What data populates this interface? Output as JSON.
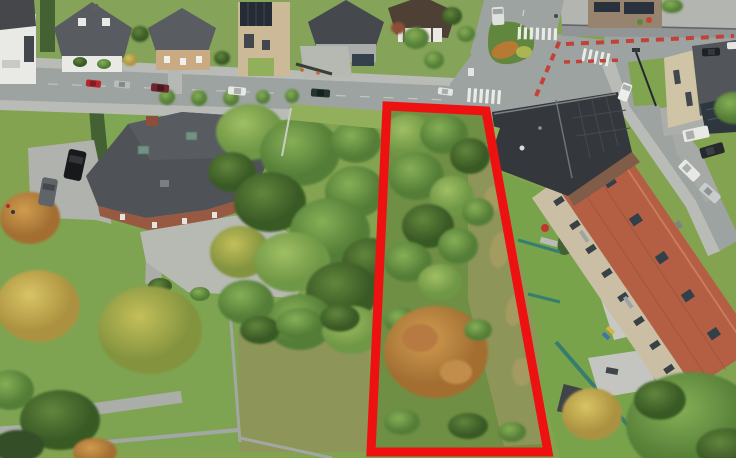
{
  "scene": {
    "type": "aerial-drone-photo",
    "subject": "vacant building plot outlined in red within a residential neighborhood"
  },
  "palette": {
    "base": "#7fa04c",
    "road": "#9aa09e",
    "sidewalk": "#b7bab4",
    "lawn": "#7ba44d",
    "lawn_light": "#8fae56",
    "meadow": "#8b9254",
    "villa_roof": "#4a4e53",
    "brick": "#94543c",
    "rowhouse_roof": "#b25a3e",
    "rowhouse_wall": "#c9bda3",
    "dark_building": "#2e3236",
    "fence_teal": "#2f7a6b",
    "stone_wall": "#8e9293",
    "zebra": "#e9ebe7",
    "bike_lane": "#c23c32",
    "outline": "#ee1111"
  },
  "plot": {
    "outline_points": "387,106 486,111 548,452 371,452",
    "outline_color": "#ee1111",
    "outline_width": 9
  }
}
